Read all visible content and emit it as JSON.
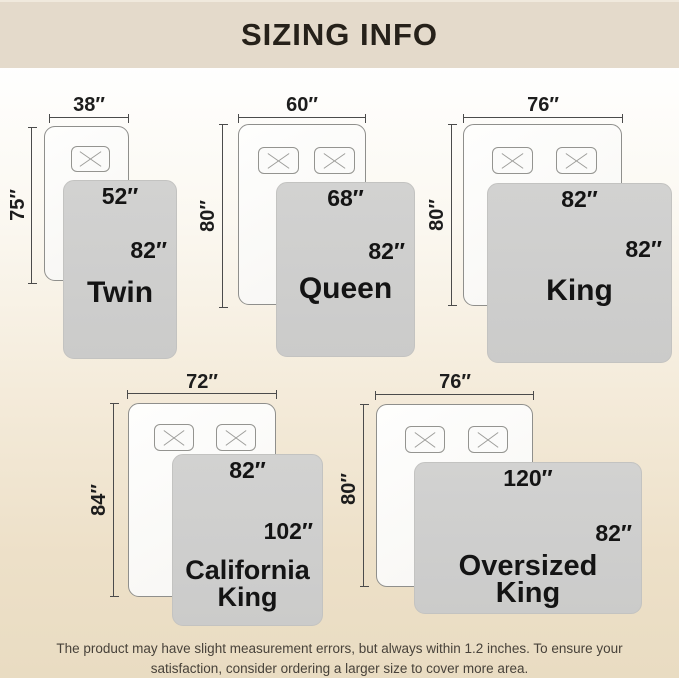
{
  "header": {
    "title": "SIZING INFO"
  },
  "sizes": [
    {
      "name": "Twin",
      "bed_width": "38″",
      "bed_length": "75″",
      "blanket_width": "52″",
      "blanket_length": "82″"
    },
    {
      "name": "Queen",
      "bed_width": "60″",
      "bed_length": "80″",
      "blanket_width": "68″",
      "blanket_length": "82″"
    },
    {
      "name": "King",
      "bed_width": "76″",
      "bed_length": "80″",
      "blanket_width": "82″",
      "blanket_length": "82″"
    },
    {
      "name": "California King",
      "bed_width": "72″",
      "bed_length": "84″",
      "blanket_width": "82″",
      "blanket_length": "102″"
    },
    {
      "name": "Oversized King",
      "bed_width": "76″",
      "bed_length": "80″",
      "blanket_width": "120″",
      "blanket_length": "82″"
    }
  ],
  "footer": {
    "line1": "The product may have slight measurement errors, but always within 1.2 inches. To ensure your",
    "line2": "satisfaction, consider ordering a larger size to cover more area."
  },
  "colors": {
    "header_bg": "#e4dacb",
    "blanket_gray": "#cdcdcc",
    "bed_white": "#fbfbfa",
    "text_dark": "#1d1d1d",
    "background_bottom": "#e9dcc2"
  }
}
